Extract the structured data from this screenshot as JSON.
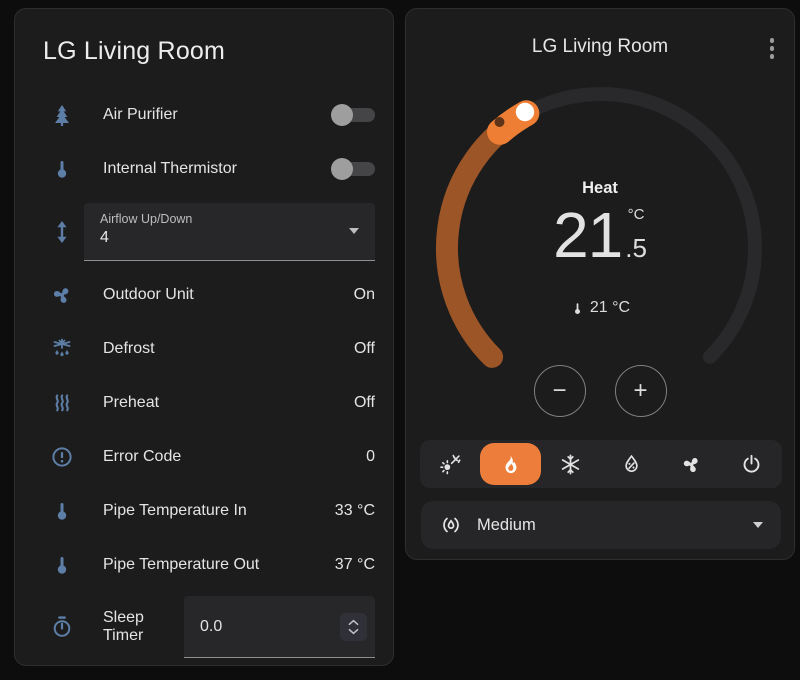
{
  "left_card": {
    "title": "LG Living Room",
    "rows": [
      {
        "icon": "pine-tree",
        "label": "Air Purifier",
        "control": "toggle",
        "state": "off"
      },
      {
        "icon": "thermometer",
        "label": "Internal Thermistor",
        "control": "toggle",
        "state": "off"
      },
      {
        "icon": "arrow-up-down",
        "label": "Airflow Up/Down",
        "control": "select",
        "value": "4"
      },
      {
        "icon": "fan",
        "label": "Outdoor Unit",
        "value": "On"
      },
      {
        "icon": "snowflake-melt",
        "label": "Defrost",
        "value": "Off"
      },
      {
        "icon": "heat-wave",
        "label": "Preheat",
        "value": "Off"
      },
      {
        "icon": "alert-circle",
        "label": "Error Code",
        "value": "0"
      },
      {
        "icon": "thermometer",
        "label": "Pipe Temperature In",
        "value": "33 °C"
      },
      {
        "icon": "thermometer",
        "label": "Pipe Temperature Out",
        "value": "37 °C"
      },
      {
        "icon": "timer",
        "label": "Sleep Timer",
        "control": "number",
        "value": "0.0"
      }
    ]
  },
  "right_card": {
    "title": "LG Living Room",
    "hvac_action": "Heat",
    "target_temperature": {
      "int": "21",
      "fraction": ".5",
      "unit": "°C"
    },
    "current_temperature": "21 °C",
    "buttons": {
      "decrease": "−",
      "increase": "+"
    },
    "modes": [
      {
        "icon": "sun-snowflake",
        "active": false
      },
      {
        "icon": "fire",
        "active": true
      },
      {
        "icon": "snowflake",
        "active": false
      },
      {
        "icon": "water-percent",
        "active": false
      },
      {
        "icon": "fan",
        "active": false
      },
      {
        "icon": "power",
        "active": false
      }
    ],
    "fan_mode": {
      "icon": "fan-speed",
      "value": "Medium"
    }
  },
  "colors": {
    "accent": "#ec7d3a",
    "heat_dim": "#9c5526",
    "dial_track": "#29292b",
    "icon_blue": "#5d7ea6"
  }
}
